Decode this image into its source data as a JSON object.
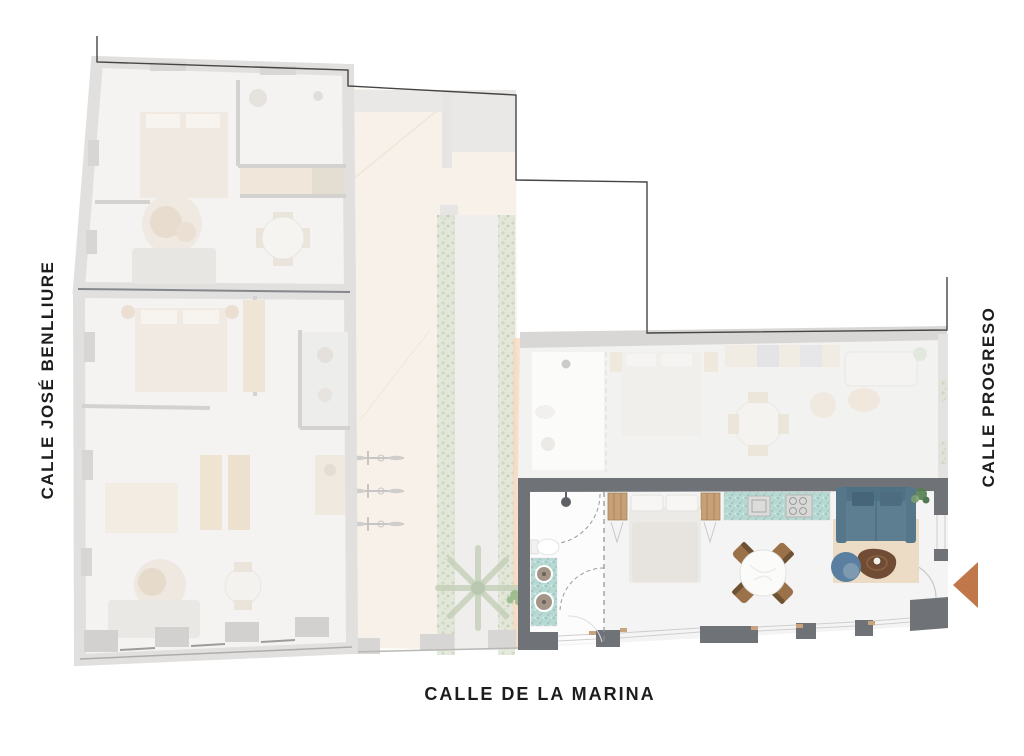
{
  "streets": {
    "left": "CALLE JOSÉ BENLLIURE",
    "right": "CALLE PROGRESO",
    "bottom": "CALLE DE LA MARINA"
  },
  "palette": {
    "label_text": "#1d1d1d",
    "active_wall": "#6f7377",
    "counter_terrazzo": "#b7d9d3",
    "wood_light": "#c7a078",
    "sofa_blue": "#567789",
    "armchair_blue": "#5b7fa0",
    "rug_beige": "#ecdcc6",
    "coffee_table_wood": "#6f4c33",
    "entrance_arrow": "#c0784a",
    "courtyard_floor": "#f8f1e9",
    "hedge_green": "#dce3d4",
    "faded_floor": "#f4f3f1",
    "faded_wall": "#e0dfde",
    "boundary_line": "#454545"
  }
}
